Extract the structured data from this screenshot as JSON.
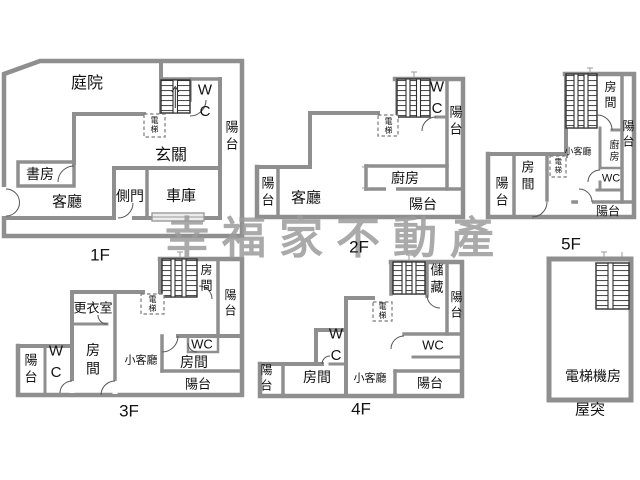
{
  "watermark": {
    "text": "幸福家不動產"
  },
  "colors": {
    "wall": "#8f8f8f",
    "stair": "#2f2f2f",
    "text": "#111111",
    "watermark": "#9c9c9c",
    "door": "#555555"
  },
  "floors": {
    "f1": {
      "label": "1F",
      "rooms": {
        "courtyard": "庭院",
        "entrance": "玄關",
        "study": "書房",
        "living": "客廳",
        "side_door": "側門",
        "garage": "車庫",
        "wc": "WC",
        "elevator": "電梯",
        "balcony_right": "陽台"
      }
    },
    "f2": {
      "label": "2F",
      "rooms": {
        "living": "客廳",
        "kitchen": "廚房",
        "wc": "WC",
        "elevator": "電梯",
        "balcony_left": "陽台",
        "balcony_right": "陽台",
        "balcony_bottom": "陽台"
      }
    },
    "f3": {
      "label": "3F",
      "rooms": {
        "dressing": "更衣室",
        "bedroom_top": "房間",
        "bedroom_left": "房間",
        "bedroom_right": "房間",
        "small_living": "小客廳",
        "wc_left": "WC",
        "wc_right": "WC",
        "elevator": "電梯",
        "balcony_left": "陽台",
        "balcony_right": "陽台",
        "balcony_bottom": "陽台"
      }
    },
    "f4": {
      "label": "4F",
      "rooms": {
        "storage": "儲藏",
        "bedroom": "房間",
        "small_living": "小客廳",
        "wc_left": "WC",
        "wc_right": "WC",
        "elevator": "電梯",
        "balcony_left": "陽台",
        "balcony_right": "陽台",
        "balcony_bottom": "陽台"
      }
    },
    "f5": {
      "label": "5F",
      "rooms": {
        "bedroom_top": "房間",
        "bedroom_left": "房間",
        "kitchen": "廚房",
        "small_living": "小客廳",
        "wc": "WC",
        "elevator": "電梯",
        "balcony_left": "陽台",
        "balcony_right": "陽台",
        "balcony_bottom": "陽台"
      }
    },
    "roof": {
      "label": "屋突",
      "rooms": {
        "machine_room": "電梯機房"
      }
    }
  }
}
